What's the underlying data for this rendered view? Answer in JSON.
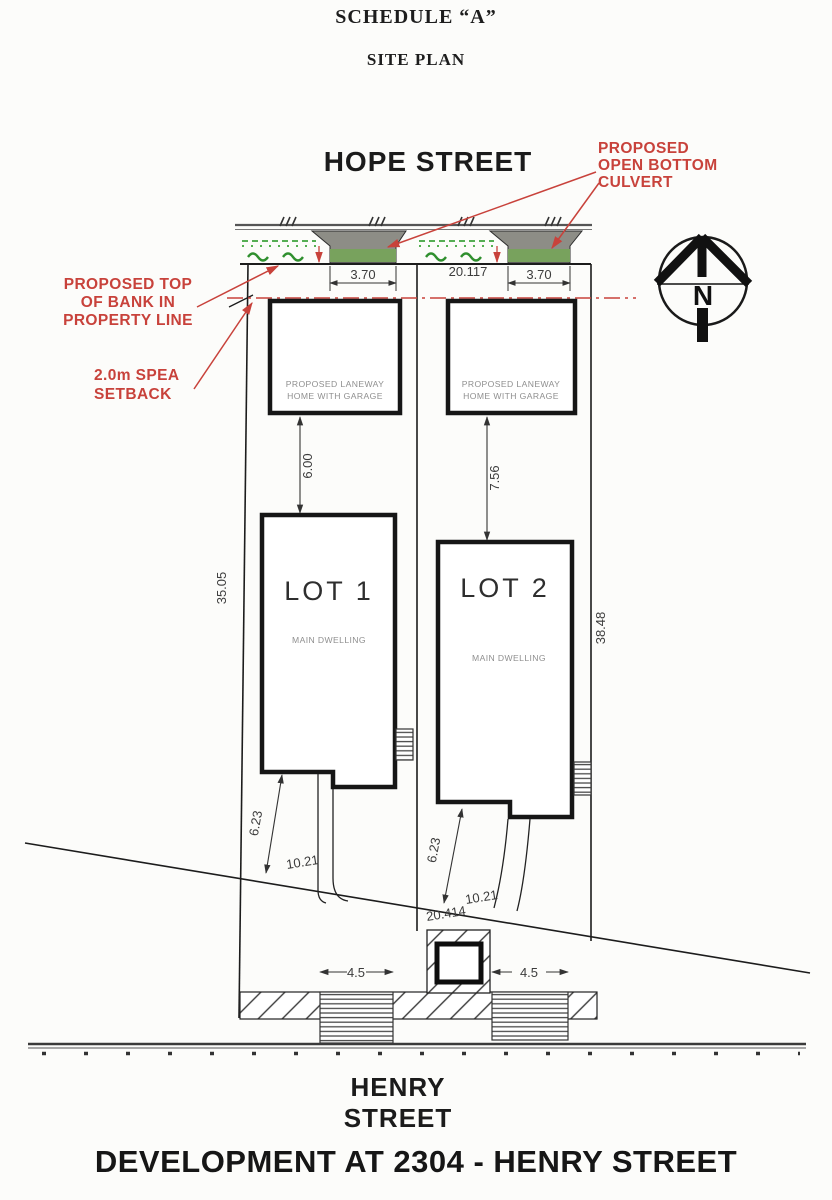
{
  "titles": {
    "schedule": "SCHEDULE “A”",
    "site_plan": "SITE PLAN",
    "development": "DEVELOPMENT AT 2304 - HENRY STREET"
  },
  "streets": {
    "top": "HOPE STREET",
    "bottom": "HENRY STREET"
  },
  "compass": {
    "north": "N"
  },
  "red_notes": {
    "culvert_l1": "PROPOSED",
    "culvert_l2": "OPEN BOTTOM",
    "culvert_l3": "CULVERT",
    "bank_l1": "PROPOSED TOP",
    "bank_l2": "OF BANK IN",
    "bank_l3": "PROPERTY LINE",
    "spea_l1": "2.0m SPEA",
    "spea_l2": "SETBACK"
  },
  "dims": {
    "frontage": "20.117",
    "rear_total": "20.414"
  },
  "lot1": {
    "label": "LOT  1",
    "dwelling": "MAIN DWELLING",
    "laneway_l1": "PROPOSED LANEWAY",
    "laneway_l2": "HOME WITH GARAGE",
    "culvert": "3.70",
    "setback": "2.00",
    "gap": "6.00",
    "side": "35.05",
    "rear": "6.23",
    "rear2": "10.21",
    "driveway": "4.5"
  },
  "lot2": {
    "label": "LOT  2",
    "dwelling": "MAIN DWELLING",
    "laneway_l1": "PROPOSED LANEWAY",
    "laneway_l2": "HOME WITH GARAGE",
    "culvert": "3.70",
    "setback": "2.00",
    "gap": "7.56",
    "side": "38.48",
    "rear": "6.23",
    "rear2": "10.21",
    "driveway": "4.5"
  },
  "colors": {
    "red": "#c8423b",
    "green": "#3fa33c",
    "culvert_gray": "#8d8d86",
    "band_green": "#78a25d"
  }
}
